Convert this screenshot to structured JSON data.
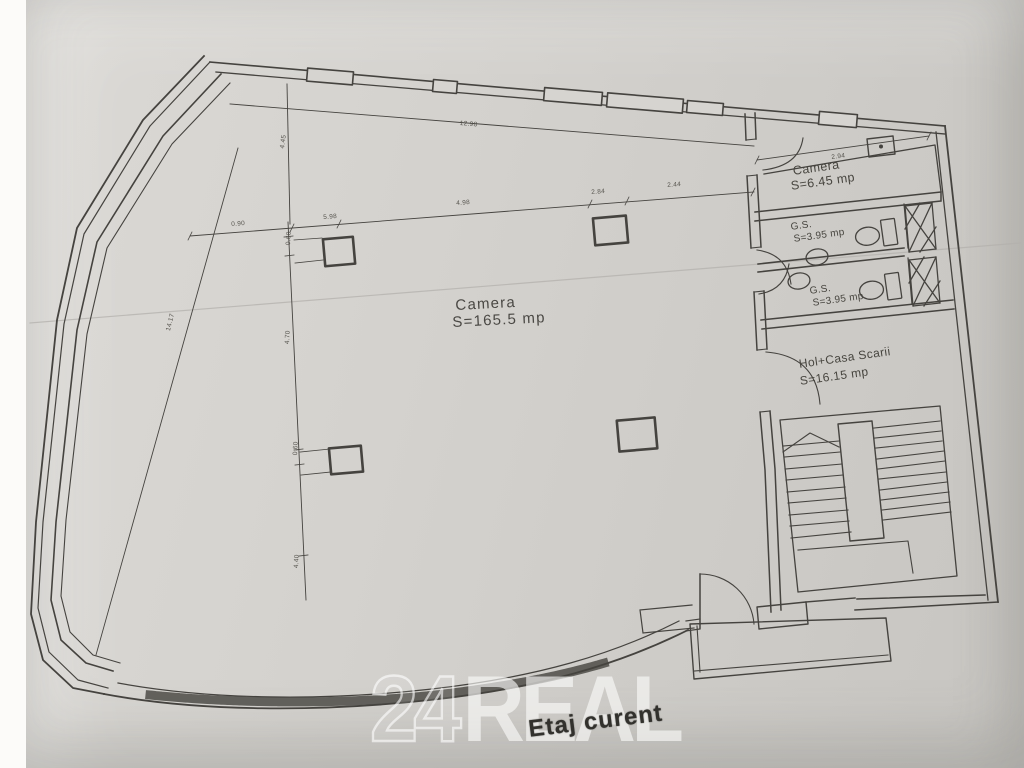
{
  "colors": {
    "paper": "#d2d0cc",
    "ink": "#45433f",
    "stamp_ink": "#32312d",
    "watermark": "#ffffff",
    "crease": "#b5b2ae"
  },
  "plan": {
    "stamp_label": "Etaj curent",
    "watermark": {
      "number": "24",
      "word": "REAL"
    },
    "rooms": {
      "main": {
        "name": "Camera",
        "area": "S=165.5 mp"
      },
      "small": {
        "name": "Camera",
        "area": "S=6.45 mp"
      },
      "gs1": {
        "name": "G.S.",
        "area": "S=3.95 mp"
      },
      "gs2": {
        "name": "G.S.",
        "area": "S=3.95 mp"
      },
      "hall": {
        "name": "Hol+Casa Scarii",
        "area": "S=16.15 mp"
      }
    },
    "dimensions": [
      "12.98",
      "4.98",
      "2.84",
      "2.44",
      "0.90",
      "5.98",
      "14.17",
      "4.70",
      "0.60",
      "0.60",
      "4.40",
      "2.94",
      "4.45"
    ]
  }
}
